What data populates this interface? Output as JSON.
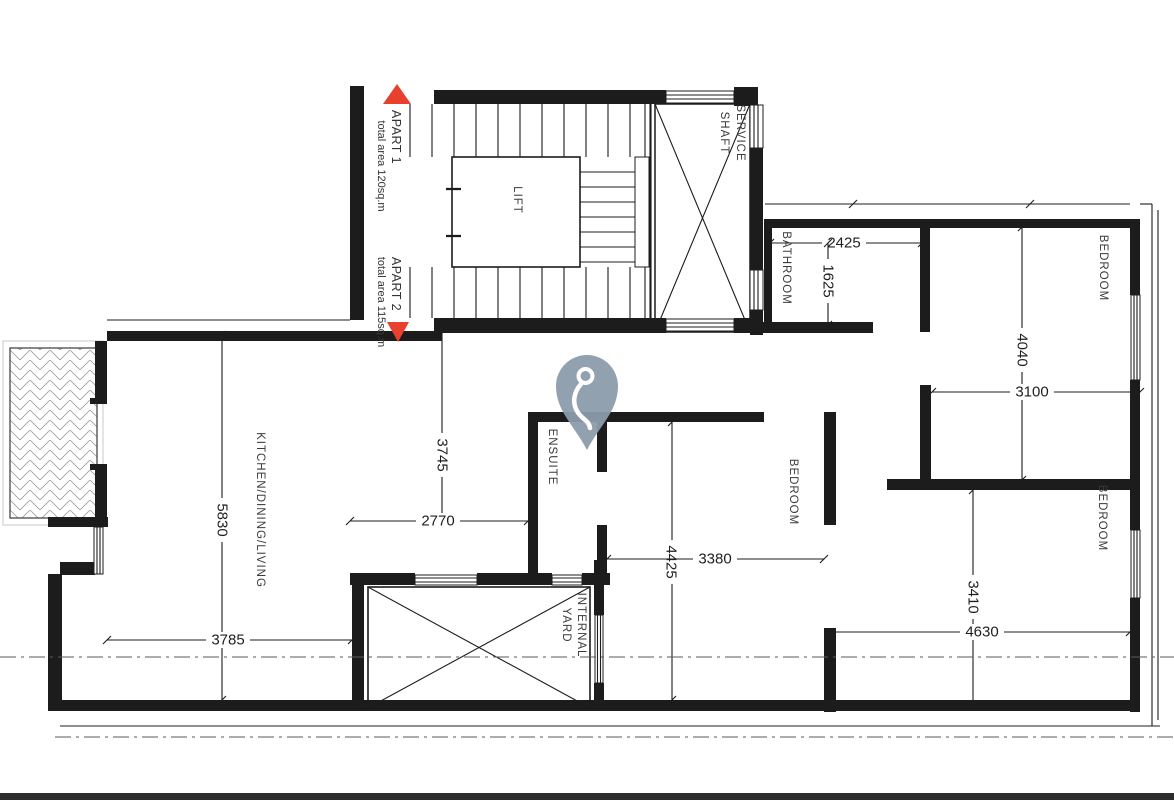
{
  "plan_labels": {
    "apart1": {
      "name": "APART 1",
      "area": "total area 120sq.m"
    },
    "apart2": {
      "name": "APART 2",
      "area": "total area 115sq.m"
    }
  },
  "rooms": {
    "lift": "LIFT",
    "service_shaft": {
      "line1": "SERVICE",
      "line2": "SHAFT"
    },
    "bathroom": "BATHROOM",
    "bedroom_top": "BEDROOM",
    "bedroom_center": "BEDROOM",
    "bedroom_bottom": "BEDROOM",
    "ensuite": "ENSUITE",
    "kitchen": "KITCHEN/DINING/LIVING",
    "internal_yard": {
      "line1": "INTERNAL",
      "line2": "YARD"
    }
  },
  "dimensions_mm": {
    "bathroom_width": "2425",
    "bathroom_depth": "1625",
    "bedroom_top_depth": "4040",
    "bedroom_top_width": "3100",
    "hall_depth": "3745",
    "hall_width": "2770",
    "kitchen_depth": "5830",
    "kitchen_width": "3785",
    "bedroom_center_depth": "4425",
    "bedroom_center_width": "3380",
    "bedroom_bottom_depth": "3410",
    "bedroom_bottom_width": "4630"
  },
  "colors": {
    "marker_pin": "#8c9cab",
    "apartment_triangle": "#e8402f",
    "drawing_line": "#1c1c1c"
  }
}
